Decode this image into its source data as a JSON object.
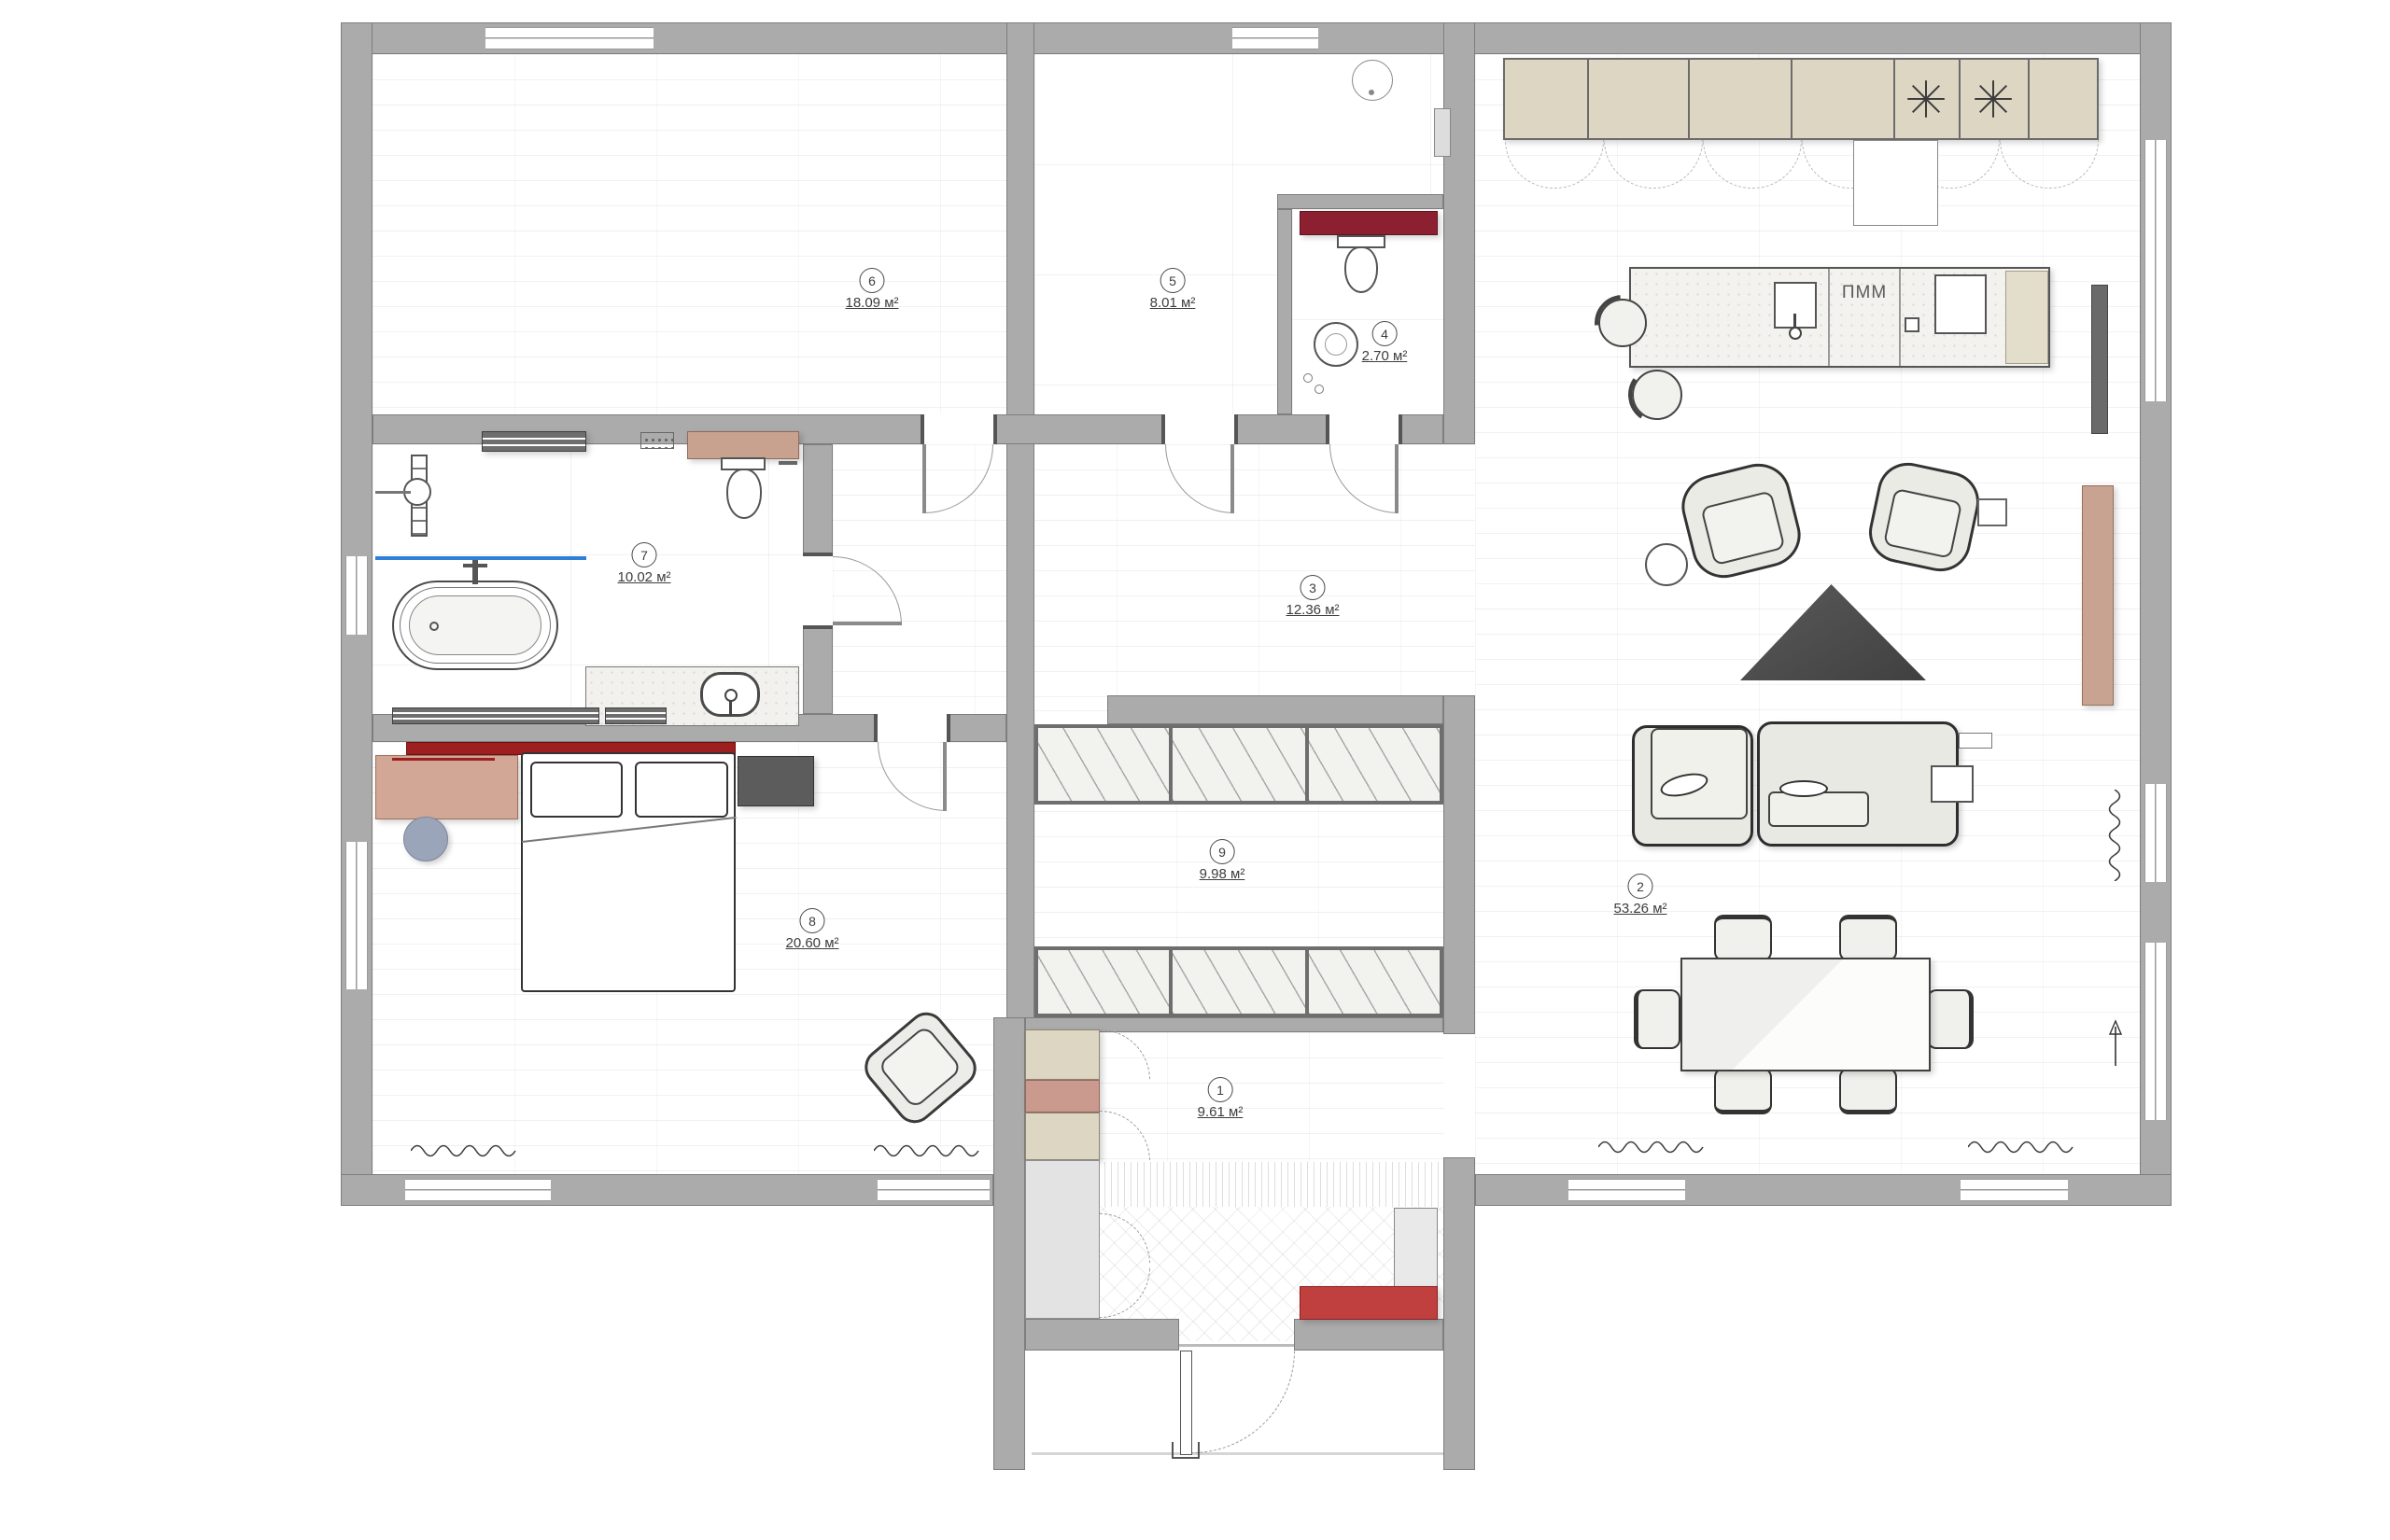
{
  "rooms": [
    {
      "number": "1",
      "area": "9.61 м²"
    },
    {
      "number": "2",
      "area": "53.26 м²"
    },
    {
      "number": "3",
      "area": "12.36 м²"
    },
    {
      "number": "4",
      "area": "2.70 м²"
    },
    {
      "number": "5",
      "area": "8.01 м²"
    },
    {
      "number": "6",
      "area": "18.09 м²"
    },
    {
      "number": "7",
      "area": "10.02 м²"
    },
    {
      "number": "8",
      "area": "20.60 м²"
    },
    {
      "number": "9",
      "area": "9.98 м²"
    }
  ],
  "kitchen": {
    "dishwasher_label": "ПММ"
  },
  "icons": {
    "freezer": "snowflake-icon",
    "radiator": "wave-icon",
    "north": "north-arrow-icon"
  },
  "palette": {
    "wall_gray": "#ababab",
    "accent_red": "#c04040",
    "dark_red": "#8c2030",
    "bed_red": "#9e1f1f",
    "cabinet_beige": "#ddd6c3",
    "wood_tan": "#c9a18f",
    "dresser_tan": "#d2a795",
    "heating_blue": "#2f7fd6",
    "furniture_dark": "#6e6e6e",
    "pouf_blue_gray": "#9aa5b9"
  }
}
